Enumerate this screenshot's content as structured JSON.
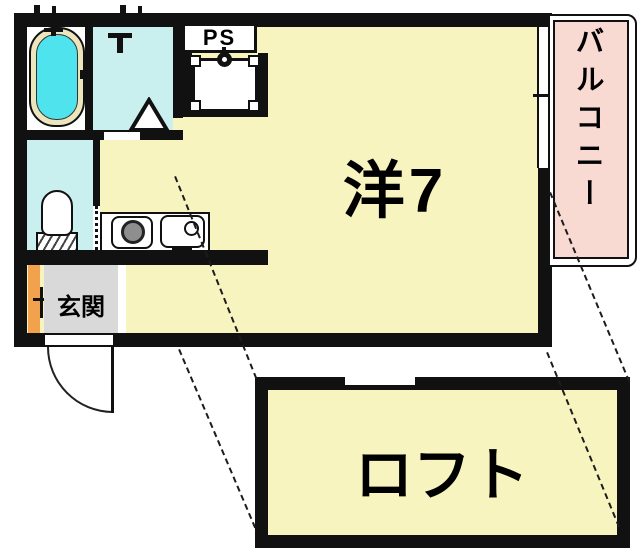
{
  "floorplan": {
    "rooms": {
      "western_room": {
        "label": "洋7"
      },
      "loft": {
        "label": "ロフト"
      },
      "balcony": {
        "label": "バルコニー"
      },
      "entrance": {
        "label": "玄関"
      },
      "pipe_shaft": {
        "label": "PS"
      }
    },
    "colors": {
      "wall": "#111111",
      "room": "#F8F4BF",
      "wet": "#C9F0EF",
      "tub": "#4FE3EE",
      "rim": "#EDE5BC",
      "pink": "#F9DAD3",
      "gray": "#D9D9D9",
      "orange": "#F2A24D",
      "stove": "#8E8E8E"
    }
  }
}
